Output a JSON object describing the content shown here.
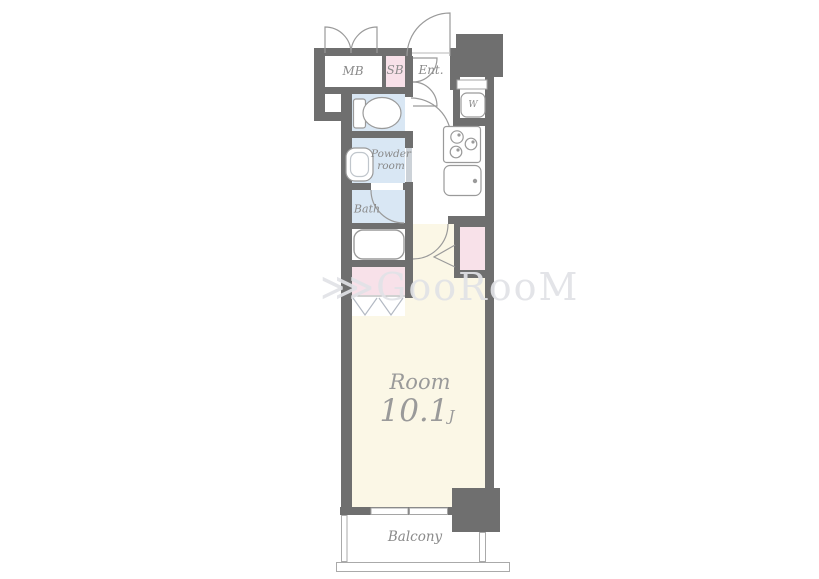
{
  "watermark": {
    "mark": "⋙",
    "text": "GooRooM"
  },
  "rooms": {
    "mb": {
      "label": "MB"
    },
    "sb": {
      "label": "SB"
    },
    "entrance": {
      "label": "Ent."
    },
    "laundry": {
      "label": "W"
    },
    "powder": {
      "line1": "Powder",
      "line2": "room"
    },
    "bath": {
      "label": "Bath"
    },
    "main": {
      "label": "Room",
      "area": "10.1",
      "unit": "J"
    },
    "balcony": {
      "label": "Balcony"
    }
  },
  "colors": {
    "wall": "#6f6f6f",
    "water_blue": "#d9e7f4",
    "closet_pink": "#f8e1e9",
    "room_cream": "#fbf7e6",
    "label_gray": "#8a8a8a",
    "line_gray": "#9a9a9a"
  }
}
